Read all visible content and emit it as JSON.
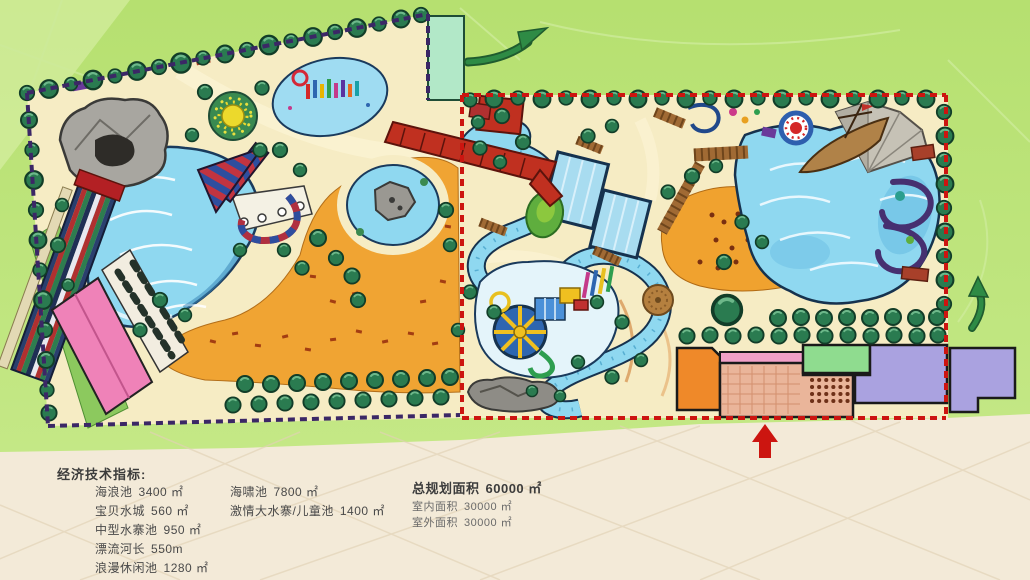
{
  "legend": {
    "title": "经济技术指标:",
    "column1": [
      {
        "label": "海浪池",
        "value": "3400 ㎡"
      },
      {
        "label": "宝贝水城",
        "value": "560 ㎡"
      },
      {
        "label": "中型水寨池",
        "value": "950 ㎡"
      },
      {
        "label": "漂流河长",
        "value": "550m"
      },
      {
        "label": "浪漫休闲池",
        "value": "1280 ㎡"
      }
    ],
    "column2": [
      {
        "label": "海啸池",
        "value": "7800 ㎡"
      },
      {
        "label": "激情大水寨/儿童池",
        "value": "1400 ㎡"
      }
    ],
    "summary": {
      "total": {
        "label": "总规划面积",
        "value": "60000 ㎡"
      },
      "indoor": {
        "label": "室内面积",
        "value": "30000 ㎡"
      },
      "outdoor": {
        "label": "室外面积",
        "value": "30000 ㎡"
      }
    }
  },
  "icons": {
    "entrance_arrow": "red up arrow (main entrance)",
    "flow_arrow_top": "green curved arrow",
    "flow_arrow_right": "green curved arrow"
  },
  "colors": {
    "background_green": "#b9e272",
    "paper_cream": "#f3ead8",
    "park_sand": "#f6ecc4",
    "beach_orange": "#f0a22f",
    "water_blue": "#8fd8f0",
    "water_outline": "#1a3a5c",
    "tree_green": "#2a7b50",
    "border_navy": "#3b2766",
    "border_red": "#cc1510",
    "structure_red": "#c03020",
    "pink_building": "#ef82b8",
    "mint_building": "#b2e8c8",
    "purple_building": "#aaa2e0",
    "green_building": "#8fdc8f",
    "orange_building": "#ef8929",
    "plaza_salmon": "#eab59a",
    "boardwalk_brown": "#9a6430",
    "rock_gray": "#a8a6a0"
  }
}
